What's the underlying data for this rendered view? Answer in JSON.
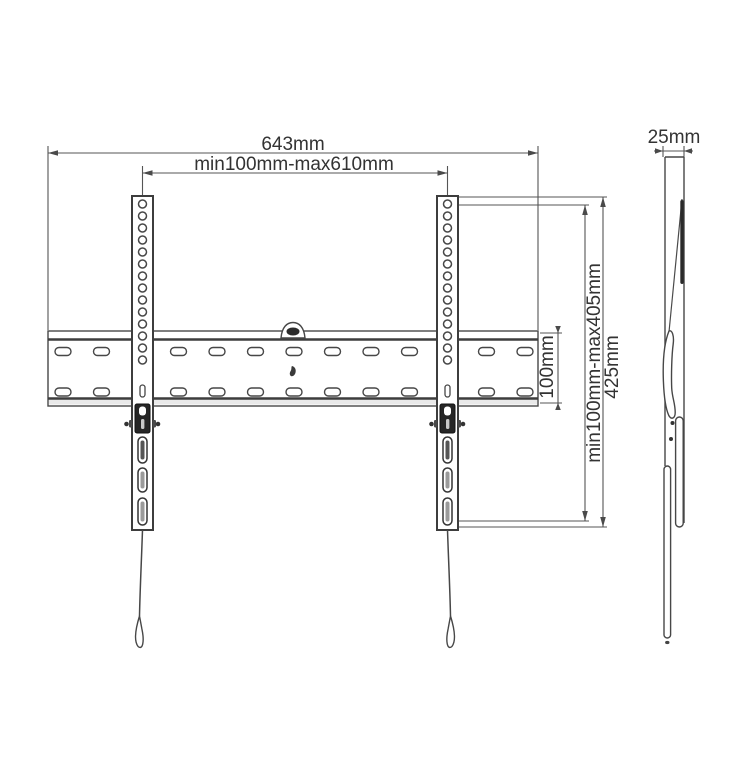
{
  "drawing": {
    "front_view": {
      "total_width": "643mm",
      "mount_width_range": "min100mm-max610mm",
      "plate_height": "100mm",
      "mount_height_range": "min100mm-max405mm",
      "bracket_height": "425mm"
    },
    "side_view": {
      "depth": "25mm"
    },
    "colors": {
      "line": "#4a4a4a",
      "text": "#333333",
      "dark_accent": "#1f1f1f",
      "background": "#ffffff"
    }
  }
}
